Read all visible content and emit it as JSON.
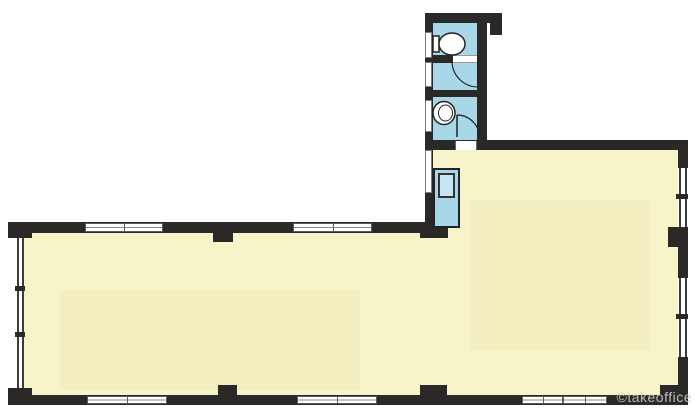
{
  "watermark": {
    "text": "©takeoffice"
  },
  "colors": {
    "floor_fill": "#f8f4c9",
    "wet_area_fill": "#a8d7e8",
    "sink_fill": "#c3e6f2",
    "wall": "#2a2927",
    "window_white": "#ffffff",
    "watermark_text": "#c9c9c9"
  },
  "fixtures": [
    "toilet",
    "door-swing-upper",
    "wash-basin",
    "door-swing-lower",
    "kitchenette-sink"
  ],
  "plan_type": "L-shaped office floor plan with WC block"
}
